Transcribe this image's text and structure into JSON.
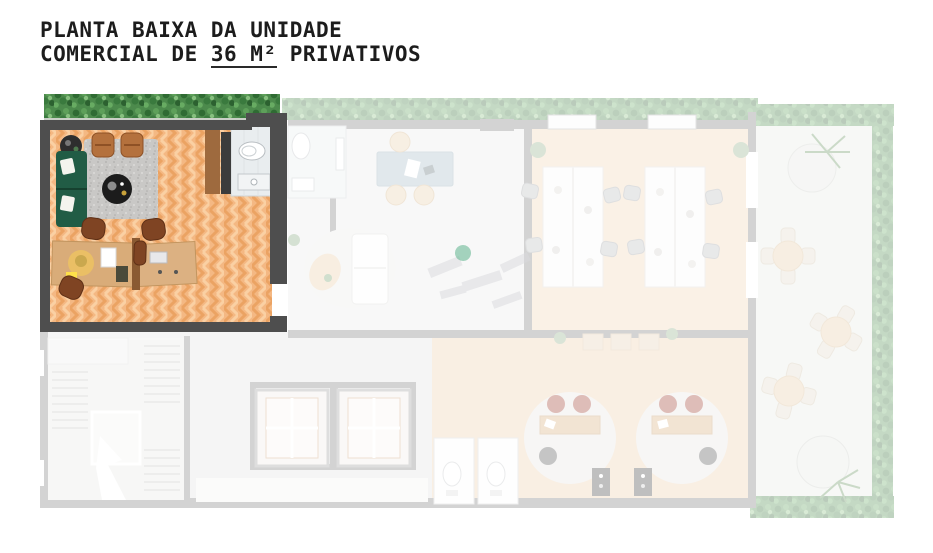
{
  "title": {
    "line1": "PLANTA BAIXA DA UNIDADE",
    "line2_prefix": "COMERCIAL DE ",
    "line2_area": "36 M²",
    "line2_suffix": " PRIVATIVOS"
  },
  "watermark": {
    "icon": "arcs-logo-icon",
    "color": "#5cb38c"
  },
  "highlighted_unit": {
    "description_source": "title",
    "floor_style": "herringbone-wood"
  },
  "colors": {
    "page_bg": "#ffffff",
    "wall_dark": "#4e4e4e",
    "wall_faded": "#7a7a7a",
    "floor_base": "#f4b883",
    "floor_chevron_dark": "#e5954f",
    "floor_chevron_light": "#fbd6ab",
    "hedge_base": "#4c8a4c",
    "planter_strip": "#c9cfc6",
    "sofa_green": "#215c45",
    "armchair_cognac": "#b4713d",
    "rug_gray": "#c9c8c6",
    "table_black": "#1c1c1c",
    "desk_wood": "#d9ac79",
    "chair_brown": "#7f4423",
    "bath_floor": "#e9edef",
    "cabinet_brown": "#9e6a3e",
    "upper_middle_floor": "#ececeb",
    "office_wood": "#f0d4b2",
    "pods_wood": "#eeceaa",
    "bottom_left_gray": "#e3e3e1",
    "terrace_floor": "#e9ebe4",
    "meeting_table_blue": "#a3bac7",
    "beige_chair": "#e9cfa9",
    "pod_chair_red": "#9c3527",
    "pod_shelf_dark": "#3a3a3a",
    "office_chair_gray": "#b9bcbe",
    "lamp_yellow": "#ffd84d"
  }
}
